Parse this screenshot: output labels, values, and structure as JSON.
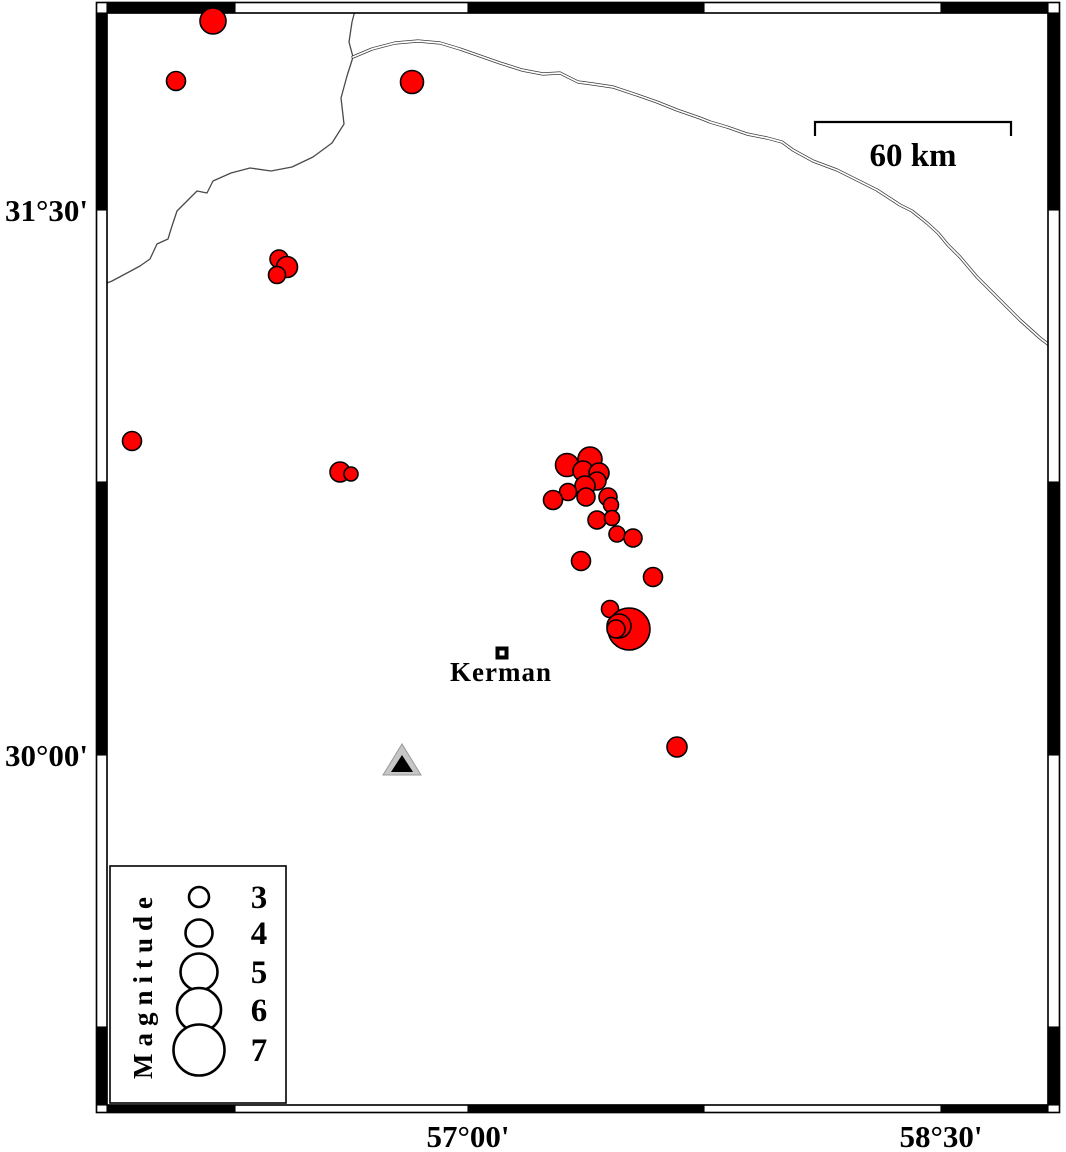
{
  "map": {
    "region_label": "Kerman area seismicity map",
    "frame": {
      "inner": {
        "left": 107,
        "top": 13,
        "right": 1048,
        "bottom": 1105
      },
      "outer": {
        "left": 96.5,
        "top": 2.5,
        "right": 1059.5,
        "bottom": 1112.5
      },
      "x_boundaries": [
        107,
        235,
        468,
        704,
        941,
        1048
      ],
      "y_boundaries": [
        13,
        210,
        482,
        755,
        1027,
        1105
      ]
    },
    "axis": {
      "y_ticks": [
        {
          "label": "31°30'",
          "y": 210
        },
        {
          "label": "30°00'",
          "y": 755
        }
      ],
      "x_ticks": [
        {
          "label": "57°00'",
          "x": 468
        },
        {
          "label": "58°30'",
          "x": 941
        }
      ]
    },
    "scale_bar": {
      "label": "60 km",
      "x1": 815,
      "x2": 1011,
      "y": 122,
      "tick_drop": 14
    },
    "city": {
      "label": "Kerman",
      "x": 502,
      "y": 653
    },
    "station": {
      "symbol": "triangle",
      "x": 402,
      "apex_y": 744,
      "base_y": 775,
      "half_width": 19,
      "fill": "#c6c6c6",
      "inner_fill": "#000000"
    },
    "legend": {
      "title": "Magnitude",
      "box": {
        "left": 110,
        "top": 866,
        "right": 286,
        "bottom": 1103
      },
      "circle_x": 199,
      "number_x": 259,
      "entries": [
        {
          "label": "3",
          "y": 897,
          "d": 20
        },
        {
          "label": "4",
          "y": 933,
          "d": 27
        },
        {
          "label": "5",
          "y": 972,
          "d": 37
        },
        {
          "label": "6",
          "y": 1010,
          "d": 44
        },
        {
          "label": "7",
          "y": 1050,
          "d": 51
        }
      ]
    },
    "epicenters": {
      "color": "#fe0000",
      "points": [
        {
          "x": 213,
          "y": 21,
          "d": 26
        },
        {
          "x": 176,
          "y": 81,
          "d": 19
        },
        {
          "x": 412,
          "y": 82,
          "d": 23
        },
        {
          "x": 279,
          "y": 259,
          "d": 18
        },
        {
          "x": 287,
          "y": 267,
          "d": 21
        },
        {
          "x": 277,
          "y": 275,
          "d": 17
        },
        {
          "x": 132,
          "y": 441,
          "d": 19
        },
        {
          "x": 340,
          "y": 472,
          "d": 20
        },
        {
          "x": 351,
          "y": 474,
          "d": 14
        },
        {
          "x": 567,
          "y": 465,
          "d": 23
        },
        {
          "x": 590,
          "y": 459,
          "d": 24
        },
        {
          "x": 583,
          "y": 471,
          "d": 20
        },
        {
          "x": 599,
          "y": 473,
          "d": 20
        },
        {
          "x": 597,
          "y": 481,
          "d": 18
        },
        {
          "x": 585,
          "y": 486,
          "d": 20
        },
        {
          "x": 568,
          "y": 492,
          "d": 17
        },
        {
          "x": 553,
          "y": 500,
          "d": 19
        },
        {
          "x": 586,
          "y": 497,
          "d": 18
        },
        {
          "x": 608,
          "y": 497,
          "d": 18
        },
        {
          "x": 611,
          "y": 505,
          "d": 15
        },
        {
          "x": 597,
          "y": 520,
          "d": 18
        },
        {
          "x": 612,
          "y": 518,
          "d": 15
        },
        {
          "x": 617,
          "y": 534,
          "d": 16
        },
        {
          "x": 633,
          "y": 538,
          "d": 18
        },
        {
          "x": 581,
          "y": 561,
          "d": 19
        },
        {
          "x": 653,
          "y": 577,
          "d": 19
        },
        {
          "x": 610,
          "y": 609,
          "d": 17
        },
        {
          "x": 629,
          "y": 629,
          "d": 42
        },
        {
          "x": 619,
          "y": 626,
          "d": 24
        },
        {
          "x": 616,
          "y": 629,
          "d": 18
        },
        {
          "x": 677,
          "y": 747,
          "d": 20
        }
      ]
    },
    "lines": {
      "river": [
        [
          357,
          3
        ],
        [
          352,
          22
        ],
        [
          349,
          42
        ],
        [
          353,
          57
        ],
        [
          347,
          76
        ],
        [
          341,
          98
        ],
        [
          344,
          124
        ],
        [
          332,
          143
        ],
        [
          313,
          157
        ],
        [
          292,
          167
        ],
        [
          271,
          171
        ],
        [
          250,
          168
        ],
        [
          231,
          173
        ],
        [
          213,
          181
        ],
        [
          207,
          193
        ],
        [
          197,
          191
        ],
        [
          187,
          201
        ],
        [
          177,
          211
        ],
        [
          172,
          226
        ],
        [
          168,
          239
        ],
        [
          157,
          244
        ],
        [
          150,
          259
        ],
        [
          140,
          266
        ],
        [
          127,
          273
        ],
        [
          112,
          281
        ],
        [
          107,
          283
        ]
      ],
      "road": [
        [
          353,
          57
        ],
        [
          372,
          49
        ],
        [
          395,
          43
        ],
        [
          418,
          41
        ],
        [
          440,
          43
        ],
        [
          460,
          49
        ],
        [
          480,
          56
        ],
        [
          500,
          63
        ],
        [
          522,
          70
        ],
        [
          543,
          74
        ],
        [
          560,
          73
        ],
        [
          578,
          82
        ],
        [
          593,
          84
        ],
        [
          613,
          87
        ],
        [
          637,
          95
        ],
        [
          657,
          102
        ],
        [
          677,
          110
        ],
        [
          700,
          118
        ],
        [
          710,
          122
        ],
        [
          727,
          127
        ],
        [
          747,
          134
        ],
        [
          767,
          138
        ],
        [
          782,
          142
        ],
        [
          793,
          150
        ],
        [
          813,
          161
        ],
        [
          837,
          170
        ],
        [
          853,
          178
        ],
        [
          877,
          190
        ],
        [
          900,
          205
        ],
        [
          912,
          211
        ],
        [
          927,
          223
        ],
        [
          938,
          233
        ],
        [
          948,
          245
        ],
        [
          960,
          257
        ],
        [
          977,
          277
        ],
        [
          997,
          297
        ],
        [
          1020,
          320
        ],
        [
          1040,
          338
        ],
        [
          1053,
          348
        ]
      ]
    }
  }
}
